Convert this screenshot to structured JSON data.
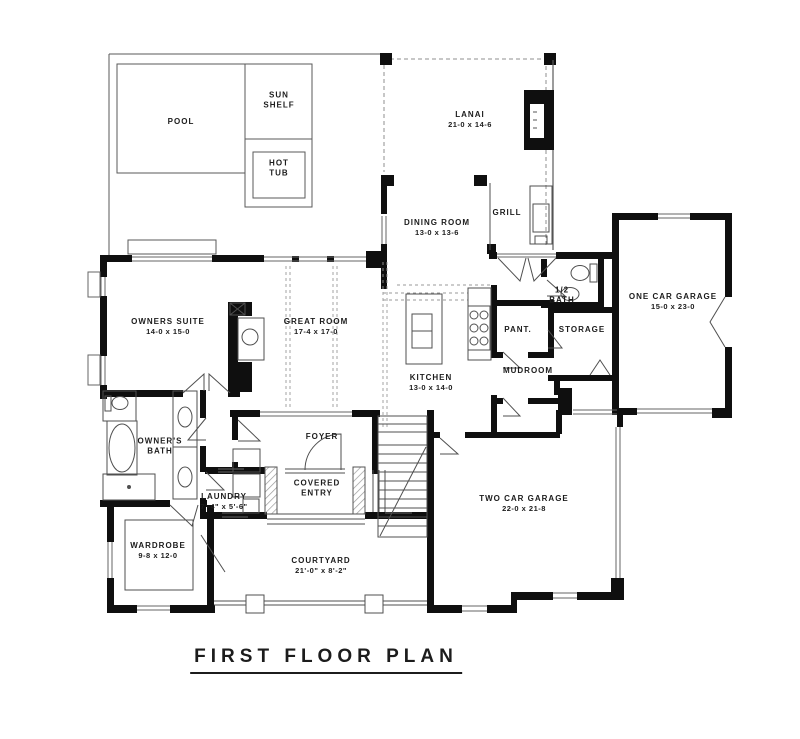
{
  "title": "FIRST FLOOR PLAN",
  "rooms": {
    "pool": {
      "name": "POOL"
    },
    "sun_shelf": {
      "name": "SUN SHELF"
    },
    "hot_tub": {
      "name": "HOT TUB"
    },
    "lanai": {
      "name": "LANAI",
      "dims": "21-0 x 14-6"
    },
    "dining_room": {
      "name": "DINING ROOM",
      "dims": "13-0 x 13-6"
    },
    "grill": {
      "name": "GRILL"
    },
    "owners_suite": {
      "name": "OWNERS SUITE",
      "dims": "14-0 x 15-0"
    },
    "great_room": {
      "name": "GREAT ROOM",
      "dims": "17-4 x 17-0"
    },
    "kitchen": {
      "name": "KITCHEN",
      "dims": "13-0 x 14-0"
    },
    "pantry": {
      "name": "PANT."
    },
    "half_bath": {
      "name": "1/2 BATH"
    },
    "storage": {
      "name": "STORAGE"
    },
    "mudroom": {
      "name": "MUDROOM"
    },
    "one_car_garage": {
      "name": "ONE CAR GARAGE",
      "dims": "15-0 x 23-0"
    },
    "owners_bath": {
      "name": "OWNER'S BATH"
    },
    "foyer": {
      "name": "FOYER"
    },
    "covered_entry": {
      "name": "COVERED ENTRY"
    },
    "laundry": {
      "name": "LAUNDRY",
      "dims": "7'-4\" x 5'-6\""
    },
    "two_car_garage": {
      "name": "TWO CAR GARAGE",
      "dims": "22-0 x 21-8"
    },
    "wardrobe": {
      "name": "WARDROBE",
      "dims": "9-8 x 12-0"
    },
    "courtyard": {
      "name": "COURTYARD",
      "dims": "21'-0\" x 8'-2\""
    }
  },
  "colors": {
    "wall": "#0f0f0f",
    "line": "#4f4f4f",
    "dashed": "#8f8f8f",
    "text": "#1c1c1c"
  }
}
